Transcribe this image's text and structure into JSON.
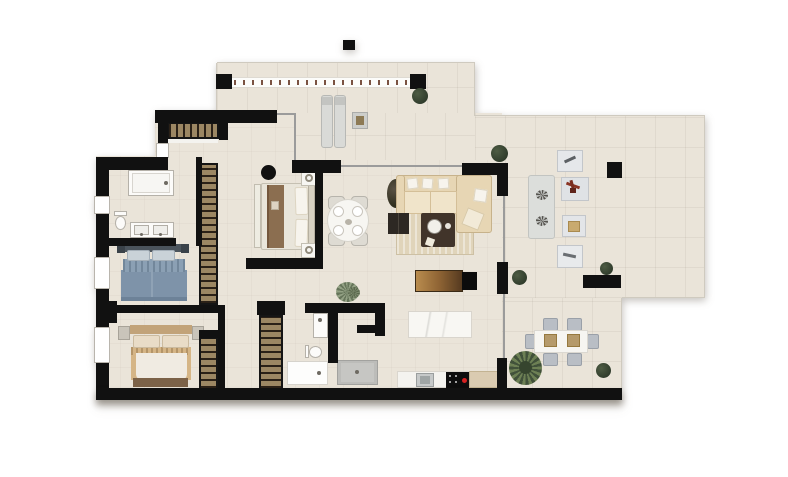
{
  "page": {
    "description": "Top-down furnished architectural floor plan render of an apartment with large wrap-around terrace; no text labels visible",
    "background": "#ffffff",
    "canvas": {
      "width": 788,
      "height": 477
    }
  },
  "palette": {
    "wall": "#111111",
    "floor": "#eae4d9",
    "terrace_edge": "#cfcabf",
    "glass": "#9b9b9b",
    "wardrobe_tan": "#9c8763",
    "bed_blue": "#7e93a9",
    "bed_beige": "#d5b586",
    "bed_brown": "#8b6e50",
    "sofa_beige": "#e7d6b4",
    "rug_beige": "#e0d4ba",
    "wood_dark": "#41342a",
    "console_gold": "#b98c4e",
    "plant_green": "#2f3b2b",
    "metal_gray": "#b9bec5",
    "accent_red": "#d62121",
    "fixture_white": "#fcfbf9",
    "railing_tick": "#7a5242"
  },
  "rooms": [
    {
      "name": "master-bedroom",
      "furniture": [
        "double-bed",
        "two-nightstands-with-lamps",
        "built-in-wardrobe",
        "round-column"
      ]
    },
    {
      "name": "bathroom-1",
      "furniture": [
        "bathtub",
        "double-sink-counter",
        "toilet"
      ]
    },
    {
      "name": "bedroom-2",
      "furniture": [
        "double-bed-blue"
      ]
    },
    {
      "name": "bedroom-3",
      "furniture": [
        "double-bed-beige",
        "two-nightstands",
        "wardrobe"
      ]
    },
    {
      "name": "hallway",
      "furniture": [
        "two-corridor-wardrobes",
        "potted-plant"
      ]
    },
    {
      "name": "bathroom-2",
      "furniture": [
        "washbasin",
        "toilet",
        "shower-tray",
        "laundry-counter"
      ]
    },
    {
      "name": "kitchen",
      "furniture": [
        "marble-island",
        "counter-with-sink",
        "induction-hob-with-red-indicator"
      ]
    },
    {
      "name": "living-dining",
      "furniture": [
        "l-shaped-sofa",
        "striped-rug",
        "dark-coffee-table",
        "nesting-side-tables",
        "tv-console",
        "round-dining-table-with-4-chairs",
        "corner-plant"
      ]
    },
    {
      "name": "terrace",
      "furniture": [
        "balcony-railing-with-posts",
        "two-sunbeds",
        "side-table",
        "double-lounger-panel",
        "four-outdoor-poufs",
        "outdoor-dining-table-6-chairs",
        "square-column",
        "planters"
      ]
    }
  ],
  "counts": {
    "plants": 8,
    "railing_posts": 2,
    "columns": 2,
    "windows": 4,
    "beds": 3
  }
}
